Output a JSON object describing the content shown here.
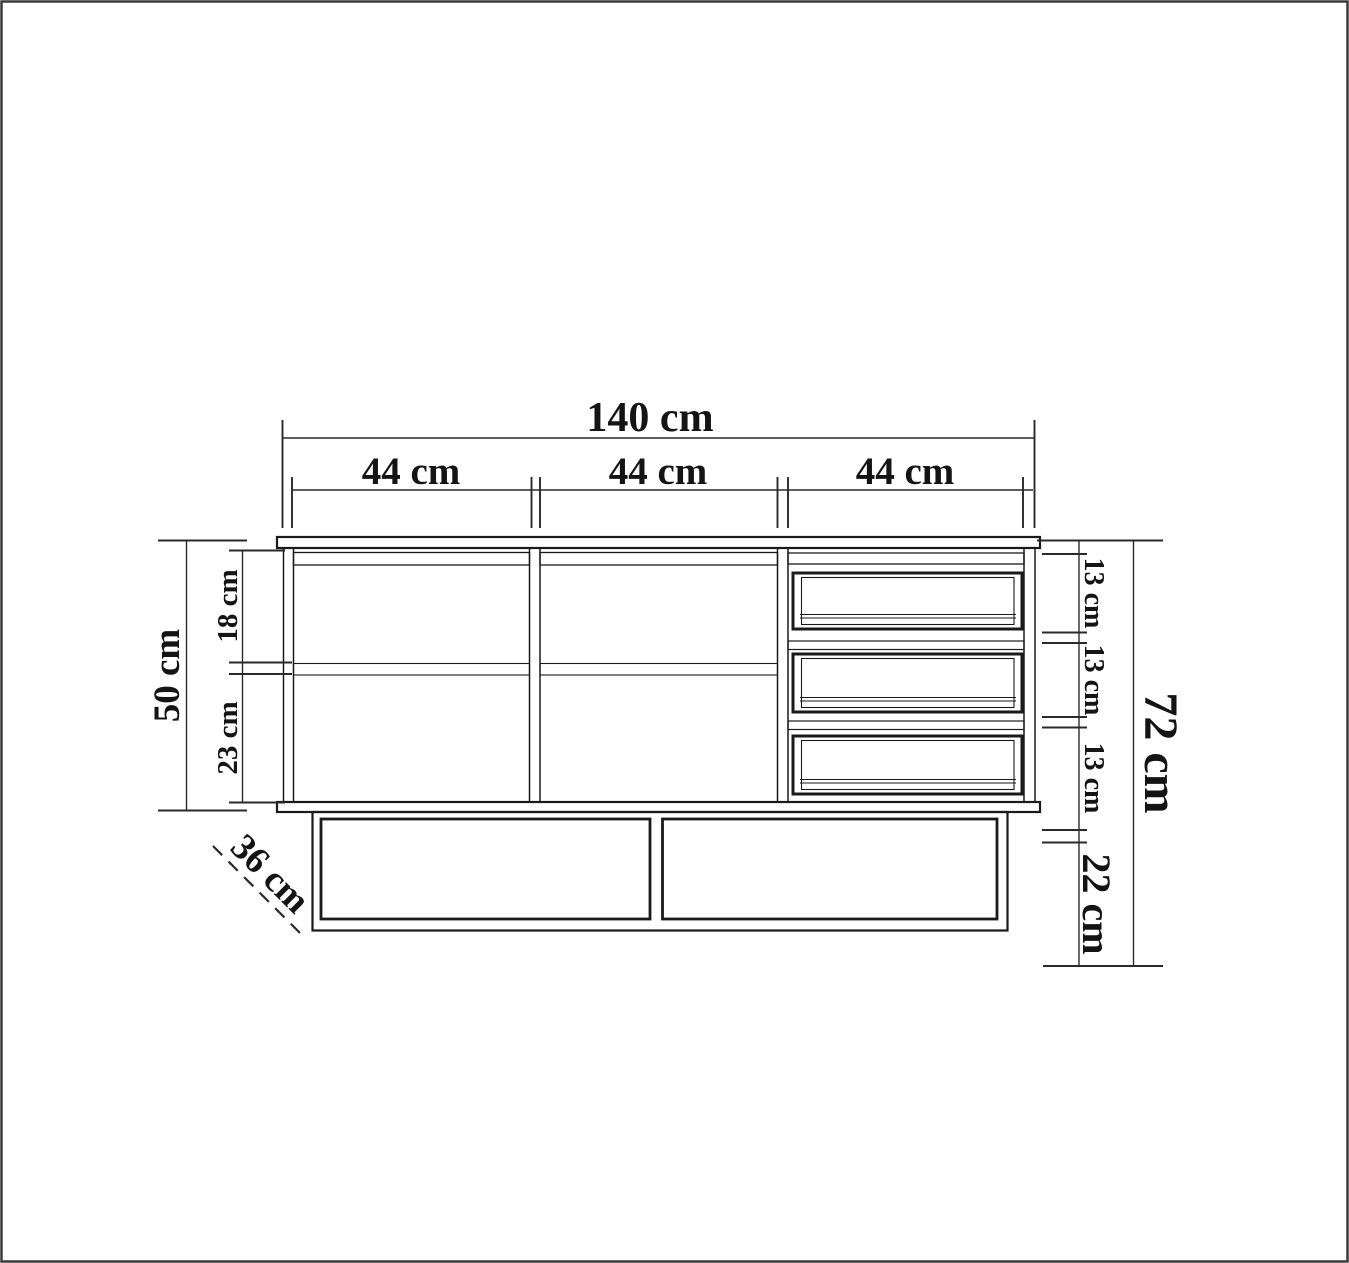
{
  "page": {
    "background": "#ffffff",
    "border_color": "#3a3a3a"
  },
  "drawing": {
    "kind": "furniture front-view dimension drawing",
    "unit": "cm",
    "line_color": "#1a1a1a",
    "text_color": "#141414",
    "labels": {
      "total_width": "140 cm",
      "section_width_1": "44 cm",
      "section_width_2": "44 cm",
      "section_width_3": "44 cm",
      "carcass_height": "50 cm",
      "top_compartment_height": "18 cm",
      "bottom_compartment_height": "23 cm",
      "drawer_1_height": "13 cm",
      "drawer_2_height": "13 cm",
      "drawer_3_height": "13 cm",
      "base_height": "22 cm",
      "total_height": "72 cm",
      "depth": "36 cm"
    }
  }
}
